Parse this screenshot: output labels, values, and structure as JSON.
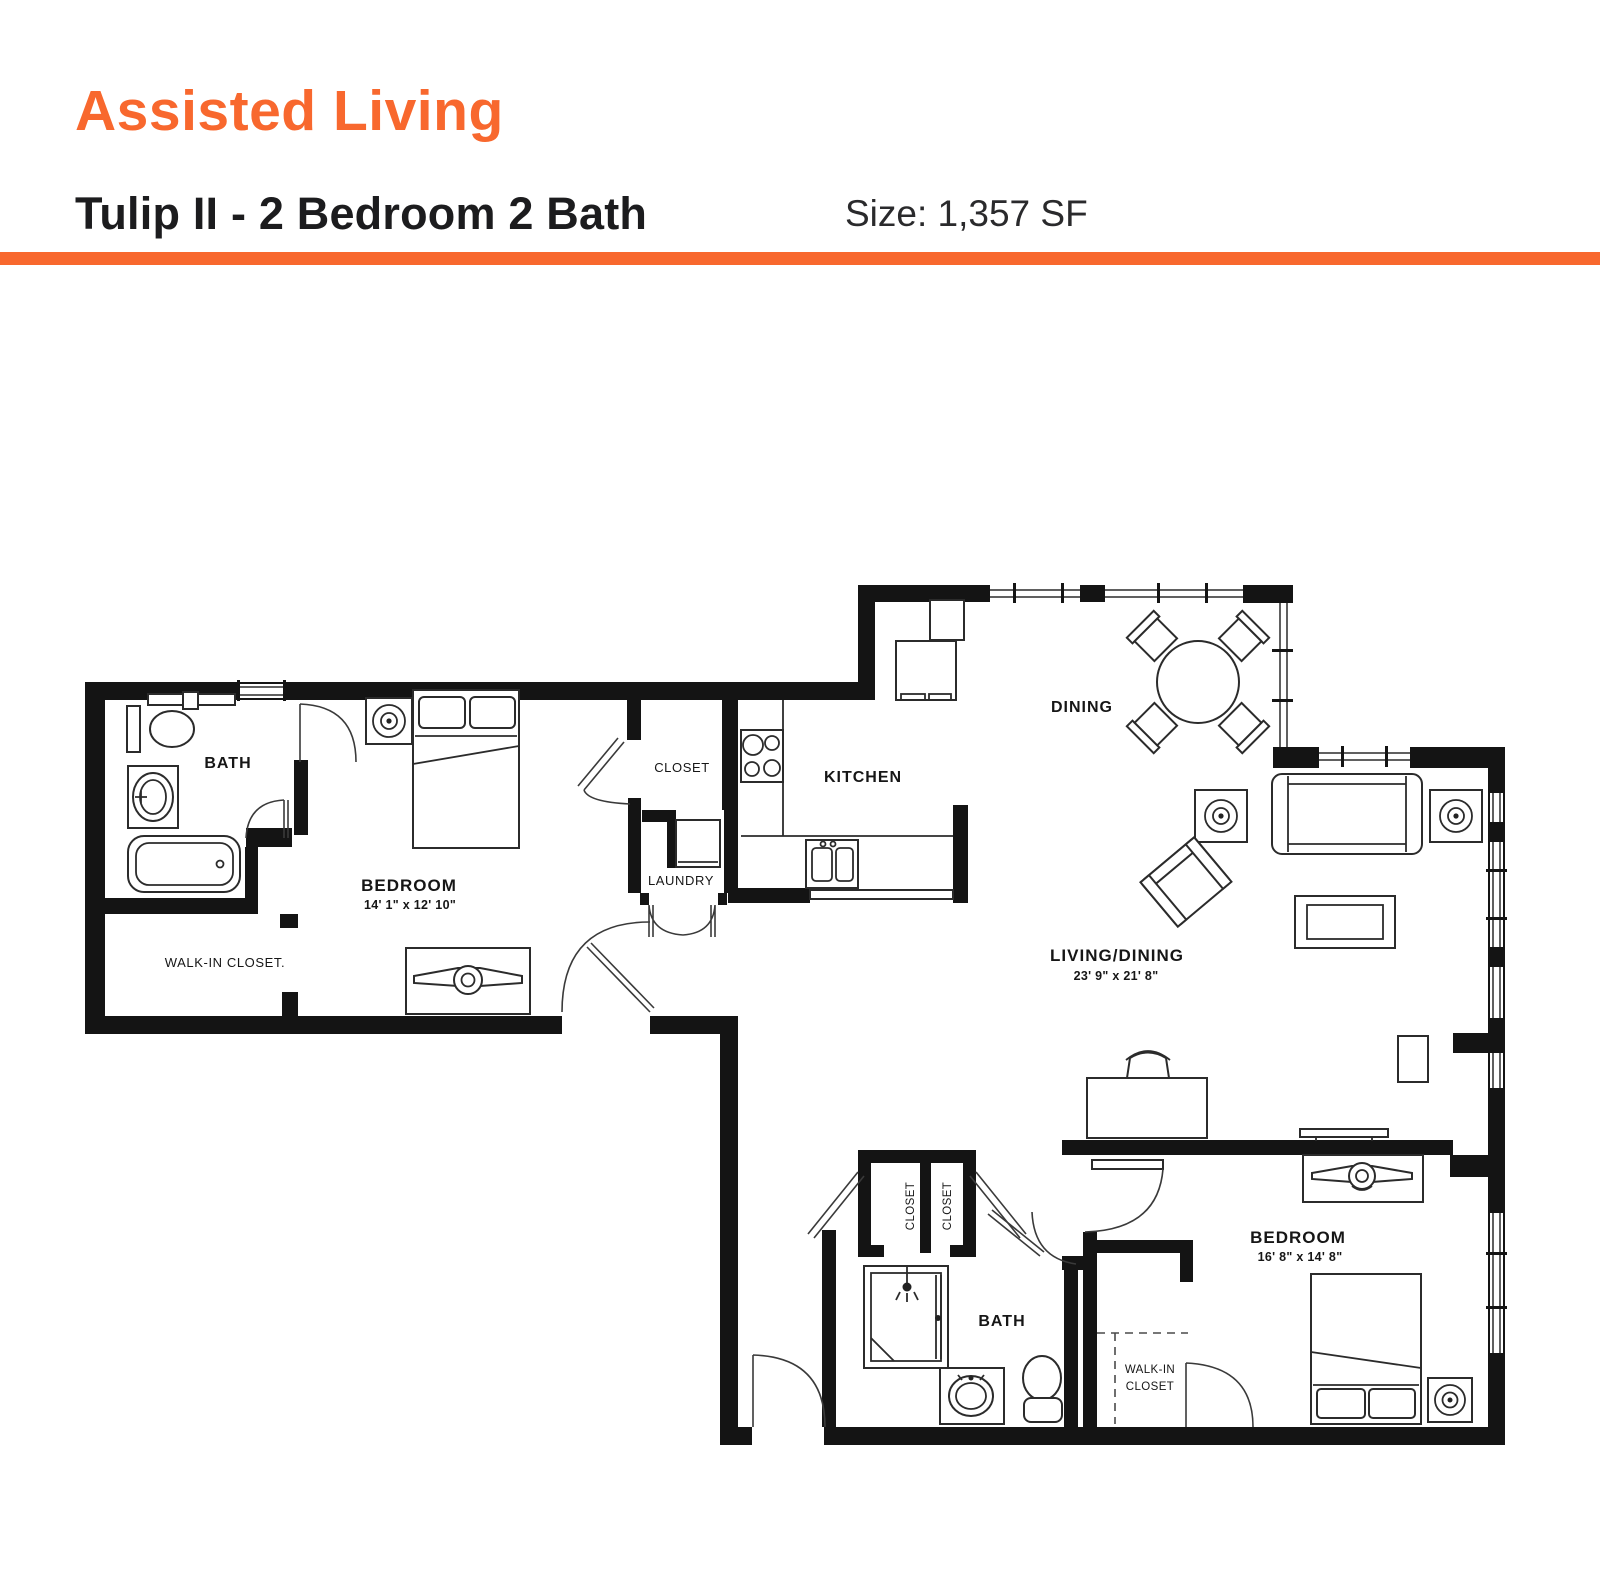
{
  "header": {
    "category": "Assisted Living",
    "unit": "Tulip II - 2 Bedroom 2 Bath",
    "size": "Size: 1,357 SF",
    "accent_color": "#F8682E"
  },
  "plan": {
    "bath1": "BATH",
    "bedroom1": "BEDROOM",
    "bedroom1_dims": "14' 1\" x 12' 10\"",
    "walkin1": "WALK-IN CLOSET.",
    "closet1": "CLOSET",
    "laundry": "LAUNDRY",
    "kitchen": "KITCHEN",
    "dining": "DINING",
    "living": "LIVING/DINING",
    "living_dims": "23' 9\" x 21' 8\"",
    "closet2a": "CLOSET",
    "closet2b": "CLOSET",
    "bath2": "BATH",
    "walkin2_line1": "WALK-IN",
    "walkin2_line2": "CLOSET",
    "bedroom2": "BEDROOM",
    "bedroom2_dims": "16' 8\" x 14' 8\""
  }
}
